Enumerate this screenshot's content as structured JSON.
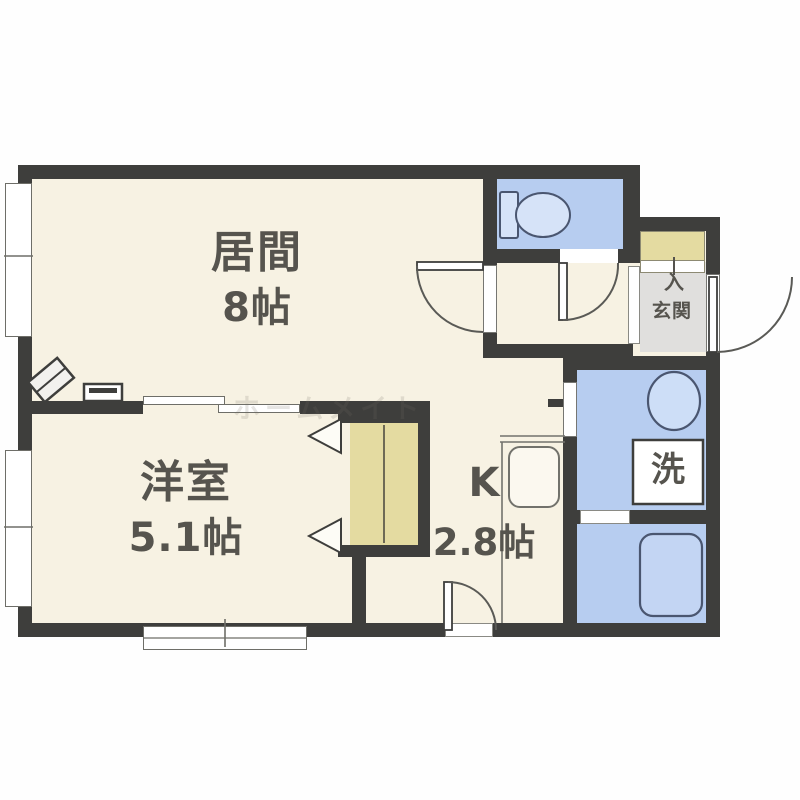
{
  "plan": {
    "type": "apartment-floor-plan",
    "rooms": {
      "living": {
        "name": "居間",
        "area": "8帖"
      },
      "western": {
        "name": "洋室",
        "area": "5.1帖"
      },
      "kitchen": {
        "name": "K",
        "area": "2.8帖"
      },
      "entrance": {
        "name": "玄関",
        "entry_mark": "入"
      },
      "washroom": {
        "washer_mark": "洗"
      }
    },
    "fixtures": [
      "toilet",
      "wash-basin",
      "washing-machine",
      "bathtub",
      "kitchen-sink",
      "closet",
      "shoe-cabinet",
      "heater"
    ],
    "watermark": "ホームメイト",
    "colors": {
      "wall": "#3e3e3c",
      "floor_cream": "#f7f2e3",
      "wet_area_blue": "#b7cdf0",
      "storage_khaki": "#e4dba1",
      "entrance_gray": "#e0dfdd",
      "fixture_outline_blue": "#4a5670"
    }
  }
}
